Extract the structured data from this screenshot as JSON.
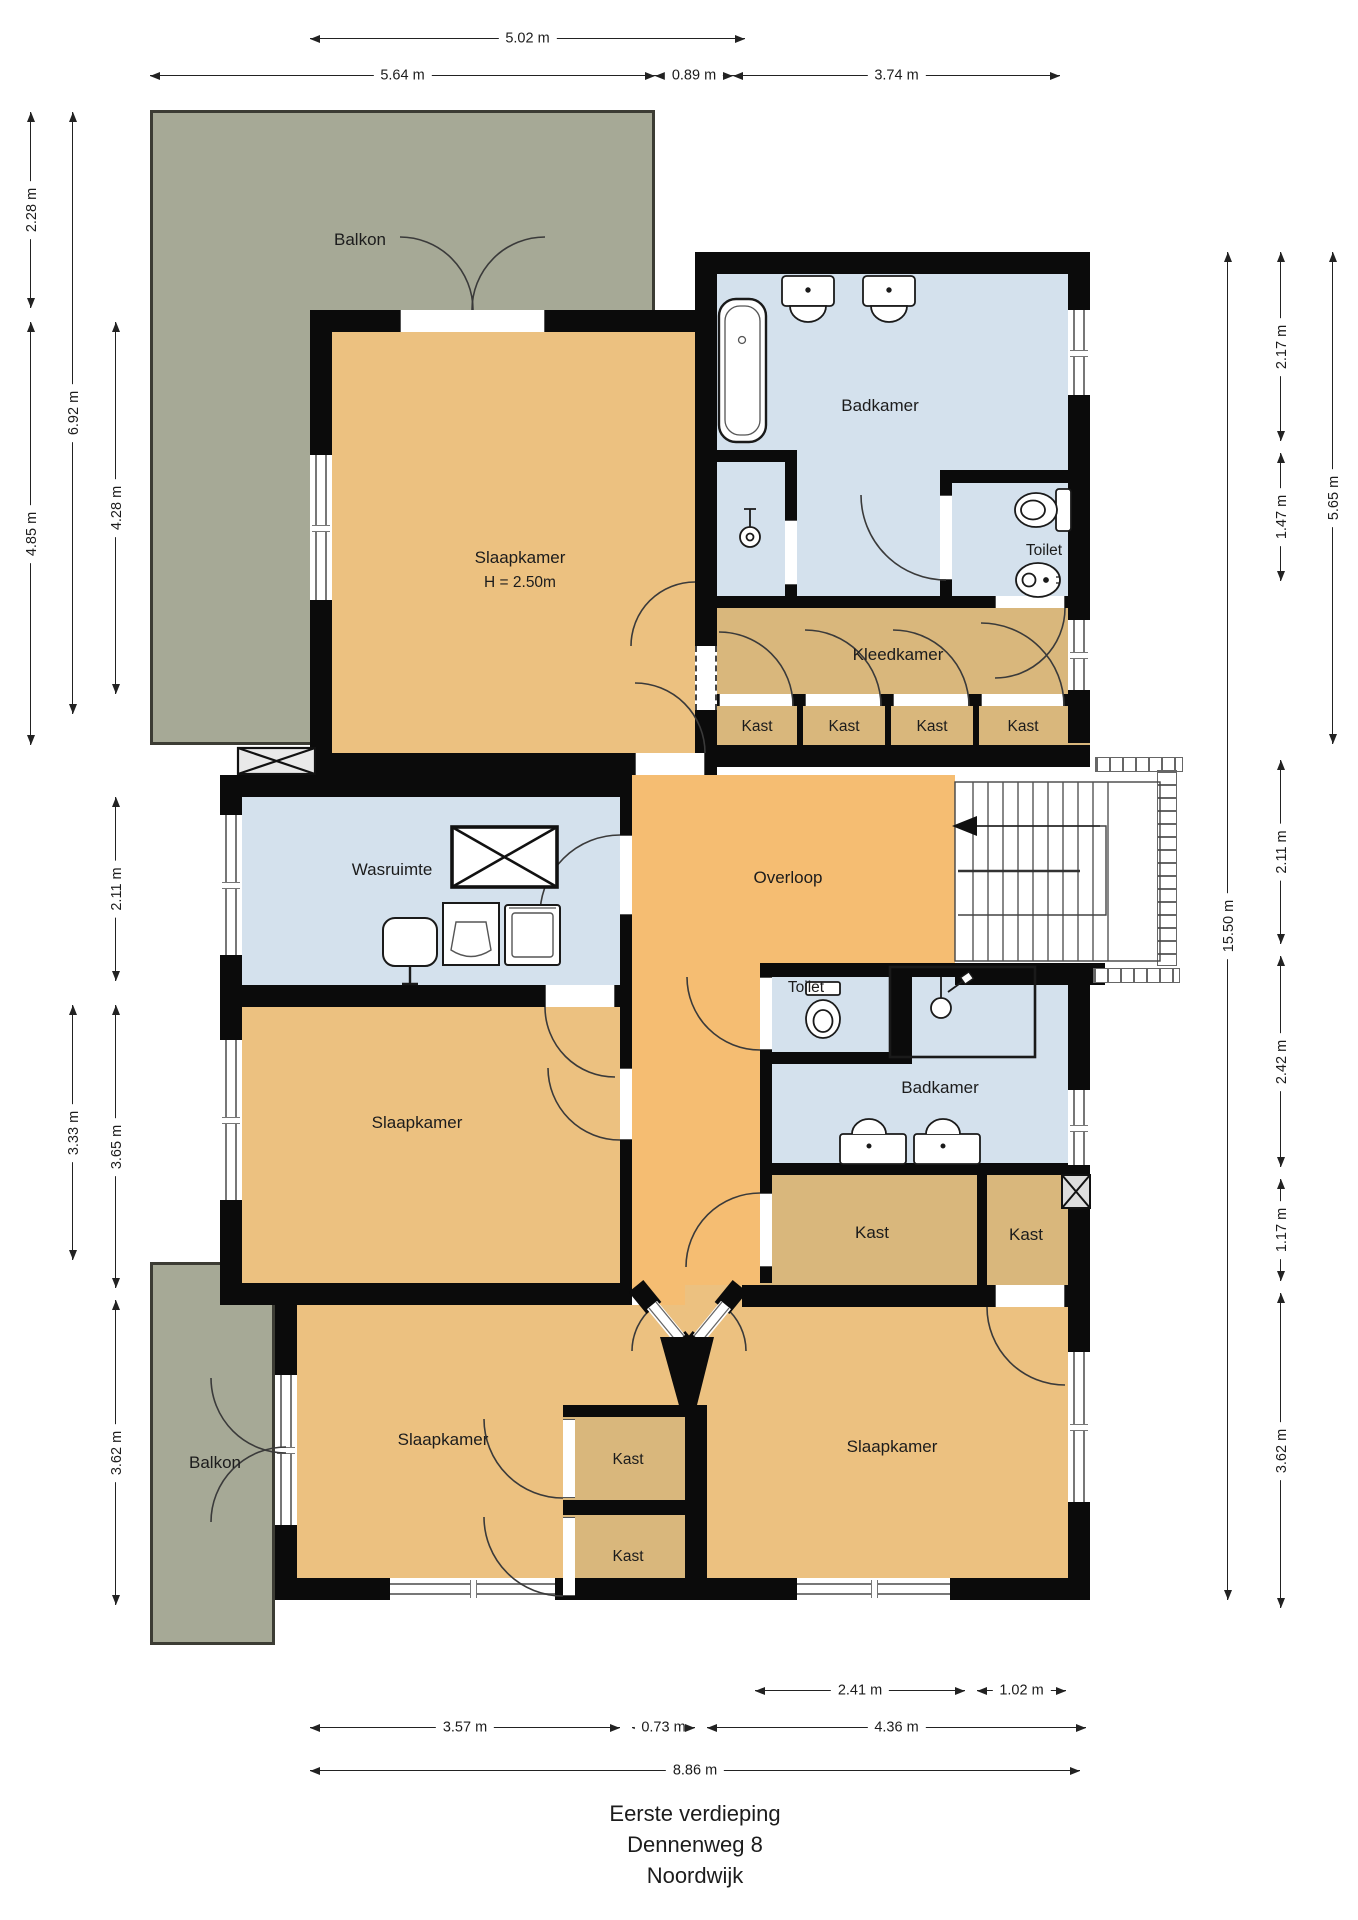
{
  "title": {
    "line1": "Eerste verdieping",
    "line2": "Dennenweg 8",
    "line3": "Noordwijk"
  },
  "rooms": {
    "balkon_top": "Balkon",
    "slaapkamer_main": "Slaapkamer",
    "slaapkamer_main_height": "H = 2.50m",
    "badkamer_top": "Badkamer",
    "toilet_top": "Toilet",
    "kleedkamer": "Kleedkamer",
    "kast_row": [
      "Kast",
      "Kast",
      "Kast",
      "Kast"
    ],
    "wasruimte": "Wasruimte",
    "overloop": "Overloop",
    "slaapkamer_mid": "Slaapkamer",
    "toilet_mid": "Toilet",
    "badkamer_mid": "Badkamer",
    "kast_mid_big": "Kast",
    "kast_mid_small": "Kast",
    "balkon_bottom": "Balkon",
    "slaapkamer_bottom_left": "Slaapkamer",
    "kast_stack1": "Kast",
    "kast_stack2": "Kast",
    "slaapkamer_bottom_right": "Slaapkamer"
  },
  "dims": {
    "top_502": "5.02 m",
    "top_564": "5.64 m",
    "top_089": "0.89 m",
    "top_374": "3.74 m",
    "left_228": "2.28 m",
    "left_692": "6.92 m",
    "left_485": "4.85 m",
    "left_428": "4.28 m",
    "left_211": "2.11 m",
    "left_333": "3.33 m",
    "left_365": "3.65 m",
    "left_362": "3.62 m",
    "right_1550": "15.50 m",
    "right_217": "2.17 m",
    "right_147": "1.47 m",
    "right_565": "5.65 m",
    "right_211": "2.11 m",
    "right_242": "2.42 m",
    "right_117": "1.17 m",
    "right_362": "3.62 m",
    "bottom_241": "2.41 m",
    "bottom_102": "1.02 m",
    "bottom_357": "3.57 m",
    "bottom_073": "0.73 m",
    "bottom_436": "4.36 m",
    "bottom_886": "8.86 m"
  },
  "colors": {
    "room_tan": "#ECC180",
    "corridor_tan": "#F5BD72",
    "closet_tan": "#D9B77C",
    "bath_blue": "#D4E1ED",
    "balcony_grey": "#A6A996",
    "wall_black": "#0b0b0b"
  },
  "icons": [
    "bathtub-icon",
    "sink-icon",
    "shower-head-icon",
    "toilet-icon",
    "bidet-icon",
    "laundry-sink-icon",
    "washing-machine-icon",
    "dryer-icon",
    "vent-shaft-icon",
    "stairs-icon",
    "stair-direction-arrow-icon",
    "door-arc-icon",
    "window-icon"
  ]
}
